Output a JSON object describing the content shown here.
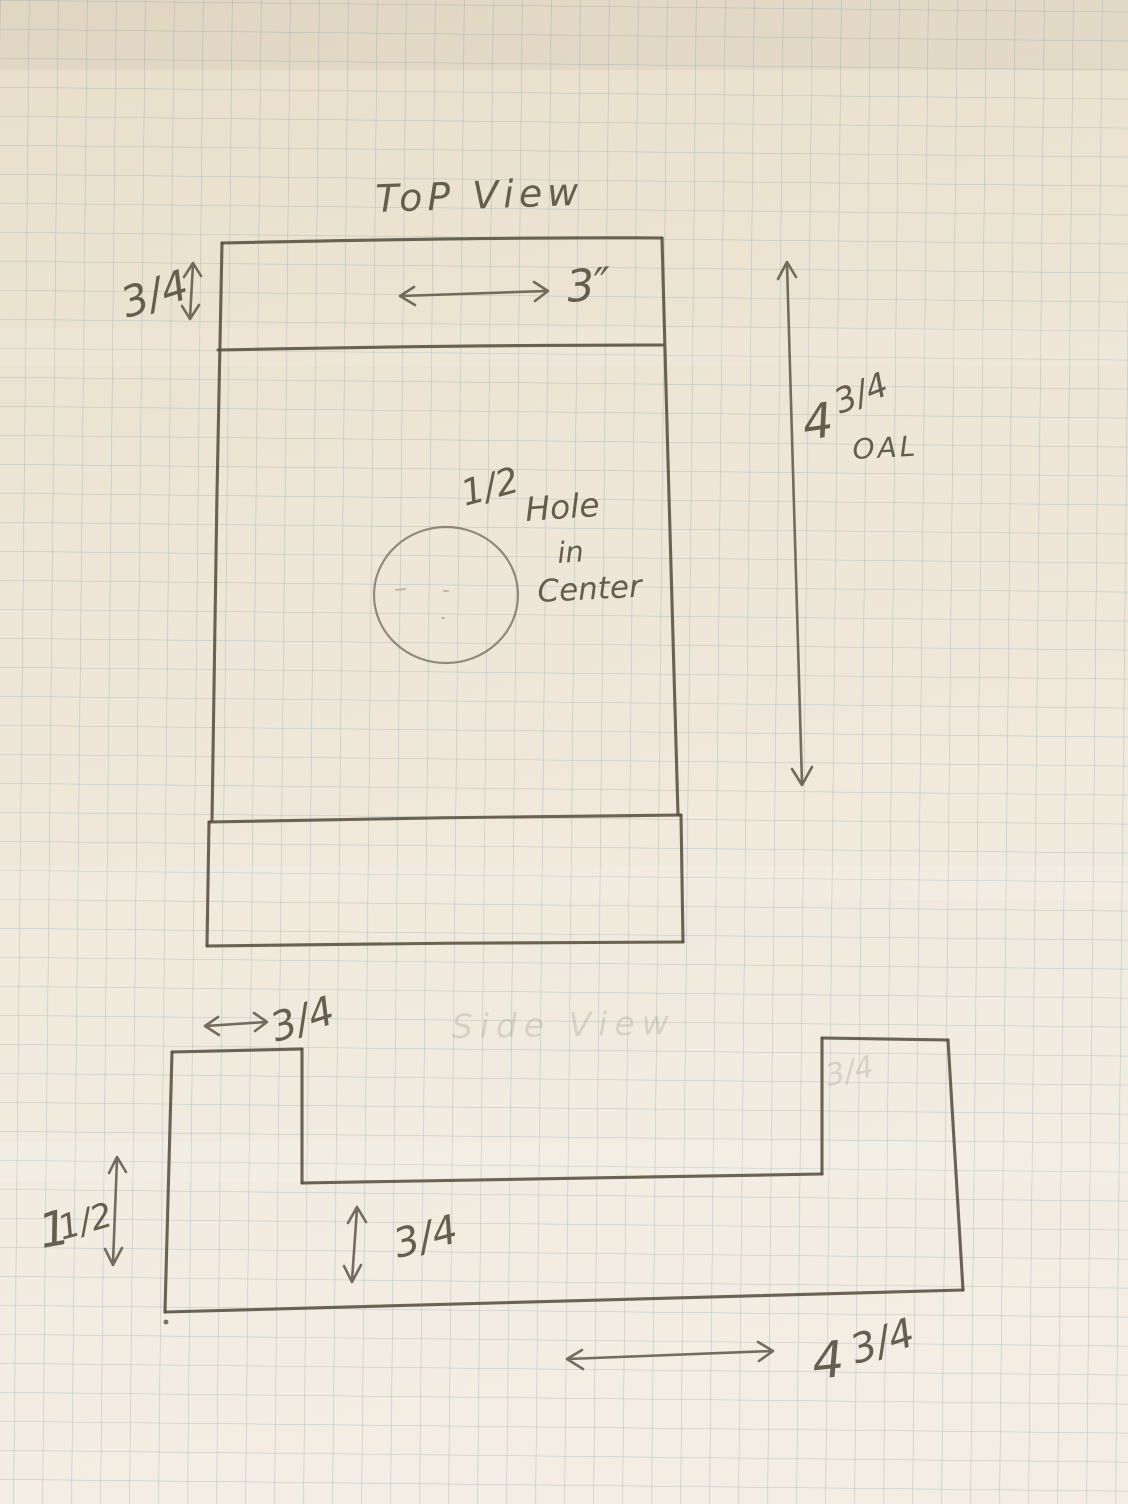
{
  "colors": {
    "paper_top": "#e9dfcb",
    "paper_bottom": "#f3ede3",
    "grid_line": "#7ea6b8",
    "pencil": "#57503f"
  },
  "top_view": {
    "title": "ToP View",
    "thickness_label": "3/4",
    "width_label": "3″",
    "oal_whole": "4",
    "oal_frac": "3/4",
    "oal_suffix": "OAL",
    "hole_size": "1/2",
    "hole_word_1": "Hole",
    "hole_word_2": "in",
    "hole_word_3": "Center"
  },
  "side_view": {
    "erased_title": "Side View",
    "tab_width_label": "3/4",
    "height_whole": "1",
    "height_frac": "1/2",
    "web_thickness_label": "3/4",
    "erased_tab_label": "3/4",
    "length_whole": "4",
    "length_frac": "3/4"
  }
}
